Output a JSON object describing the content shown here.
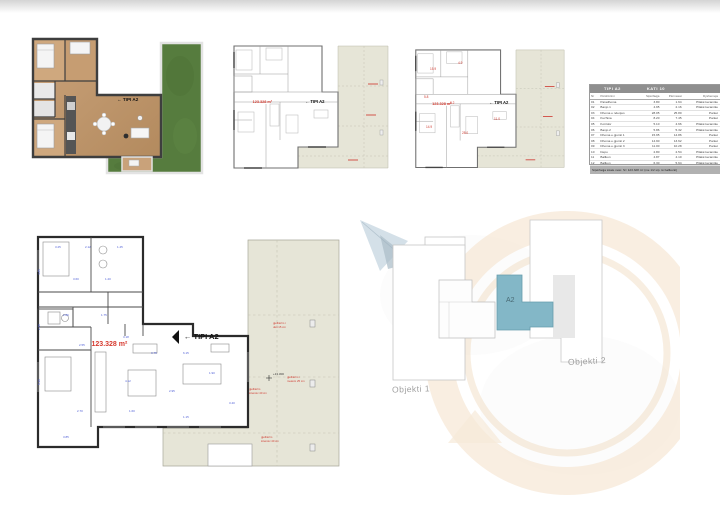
{
  "sheet": {
    "tip_label": "← TIPI A2",
    "area_small": "123.328 m²",
    "area_big": "123.328 m²",
    "elevation": "+13.300"
  },
  "colors": {
    "terrace_beige": "#e6e5d7",
    "grass_green": "#567c3e",
    "wood": "#c19a6f",
    "unit_blue": "#83b7c7",
    "dim_blue": "#4f5fd6",
    "accent_red": "#d63a2f",
    "watermark_orange": "#f4e0c8"
  },
  "table": {
    "title": "TIPI A2",
    "subtitle": "KATI 10",
    "headers": [
      "Nr",
      "Përshkrimi",
      "Sipërfaqja",
      "Përmasat",
      "Dyshemeja"
    ],
    "rows": [
      [
        "01",
        "Paradhoma",
        "3.80",
        "1.64",
        "Pllakë keramike"
      ],
      [
        "02",
        "Banjo 1",
        "4.95",
        "2.16",
        "Pllakë keramike"
      ],
      [
        "03",
        "Dhoma e ndenjes",
        "28.05",
        "25.80",
        "Parket"
      ],
      [
        "04",
        "Kuzhina",
        "8.20",
        "7.45",
        "Parket"
      ],
      [
        "05",
        "Korridor",
        "5.10",
        "4.66",
        "Pllakë keramike"
      ],
      [
        "06",
        "Banjo 2",
        "5.86",
        "5.32",
        "Pllakë keramike"
      ],
      [
        "07",
        "Dhoma e gjumit 1",
        "15.95",
        "14.86",
        "Parket"
      ],
      [
        "08",
        "Dhoma e gjumit 2",
        "14.90",
        "13.62",
        "Parket"
      ],
      [
        "09",
        "Dhoma e gjumit 3",
        "11.00",
        "10.28",
        "Parket"
      ],
      [
        "10",
        "Depo",
        "2.80",
        "2.54",
        "Pllakë keramike"
      ],
      [
        "11",
        "Ballkon",
        "4.87",
        "4.10",
        "Pllakë keramike"
      ],
      [
        "12",
        "Ballkon",
        "6.30",
        "5.64",
        "Pllakë keramike"
      ]
    ],
    "footer": "Sipërfaqja totale neto: S= 123.328 m² (me 1/2 sip. të ballkonit)"
  },
  "siteplan": {
    "building1": "Objekti 1",
    "building2": "Objekti 2",
    "unit": "A2"
  },
  "plan4": {
    "dims": [
      {
        "x": 22,
        "y": 14,
        "t": "3.25"
      },
      {
        "x": 52,
        "y": 14,
        "t": "2.12"
      },
      {
        "x": 84,
        "y": 14,
        "t": "1.45"
      },
      {
        "x": 8,
        "y": 40,
        "r": -90,
        "t": "4.85"
      },
      {
        "x": 8,
        "y": 95,
        "r": -90,
        "t": "2.40"
      },
      {
        "x": 8,
        "y": 150,
        "r": -90,
        "t": "5.30"
      },
      {
        "x": 40,
        "y": 46,
        "t": "3.60"
      },
      {
        "x": 72,
        "y": 46,
        "t": "1.20"
      },
      {
        "x": 30,
        "y": 82,
        "t": "2.86"
      },
      {
        "x": 68,
        "y": 82,
        "t": "1.75"
      },
      {
        "x": 46,
        "y": 112,
        "t": "2.55"
      },
      {
        "x": 90,
        "y": 104,
        "t": "3.18"
      },
      {
        "x": 118,
        "y": 120,
        "t": "3.75"
      },
      {
        "x": 150,
        "y": 120,
        "t": "6.15"
      },
      {
        "x": 92,
        "y": 148,
        "t": "4.12"
      },
      {
        "x": 136,
        "y": 158,
        "t": "2.95"
      },
      {
        "x": 176,
        "y": 140,
        "t": "1.90"
      },
      {
        "x": 44,
        "y": 178,
        "t": "2.70"
      },
      {
        "x": 96,
        "y": 178,
        "t": "1.60"
      },
      {
        "x": 150,
        "y": 184,
        "t": "1.15"
      },
      {
        "x": 196,
        "y": 170,
        "t": "3.40"
      },
      {
        "x": 30,
        "y": 204,
        "t": "3.85"
      }
    ],
    "notes": [
      {
        "x": 240,
        "y": 90,
        "t": "gjelbërim i"
      },
      {
        "x": 240,
        "y": 94,
        "t": "ulët 15 cm"
      },
      {
        "x": 216,
        "y": 156,
        "t": "gjelbërim"
      },
      {
        "x": 216,
        "y": 160,
        "t": "intensiv 40 cm"
      },
      {
        "x": 254,
        "y": 144,
        "t": "gjelbërim i"
      },
      {
        "x": 254,
        "y": 148,
        "t": "mesëm 25 cm"
      },
      {
        "x": 228,
        "y": 204,
        "t": "gjelbërim"
      },
      {
        "x": 228,
        "y": 208,
        "t": "intensiv 40 cm"
      }
    ]
  },
  "plan3": {
    "marks": [
      {
        "x": 20,
        "y": 28,
        "t": "15.9"
      },
      {
        "x": 48,
        "y": 22,
        "t": "4.9"
      },
      {
        "x": 14,
        "y": 56,
        "t": "5.8"
      },
      {
        "x": 40,
        "y": 62,
        "t": "8.2"
      },
      {
        "x": 16,
        "y": 86,
        "t": "14.9"
      },
      {
        "x": 52,
        "y": 92,
        "t": "28.0"
      },
      {
        "x": 84,
        "y": 78,
        "t": "11.0"
      }
    ]
  }
}
